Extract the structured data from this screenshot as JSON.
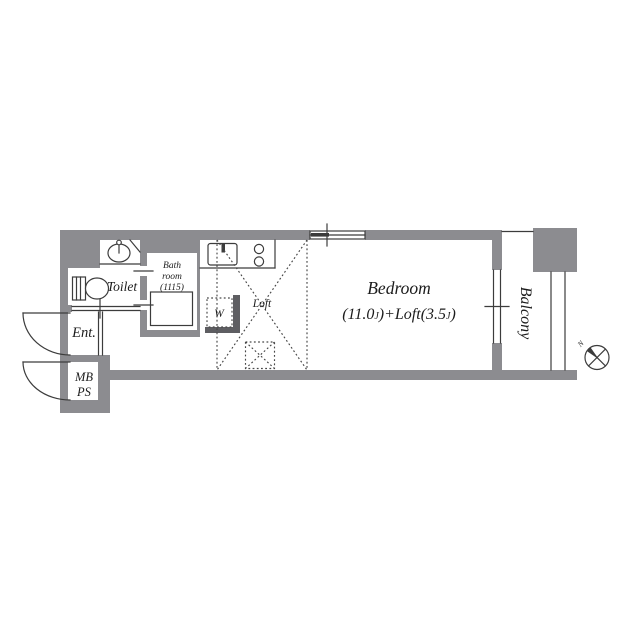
{
  "colors": {
    "wall": "#8c8c90",
    "wall_dark": "#5e5e62",
    "line": "#3c3c3c",
    "text": "#1c1c1c",
    "bg": "#ffffff"
  },
  "rooms": {
    "toilet": {
      "label": "Toilet"
    },
    "bathroom": {
      "label_line1": "Bath",
      "label_line2": "room",
      "label_line3": "(1115)"
    },
    "entrance": {
      "label": "Ent."
    },
    "meter_box": {
      "label_line1": "MB",
      "label_line2": "PS"
    },
    "closet": {
      "label": "W"
    },
    "loft": {
      "label": "Loft"
    },
    "bedroom": {
      "label": "Bedroom",
      "size_open": "(11.0",
      "size_unit1": "J",
      "size_mid": ")+Loft(3.5",
      "size_unit2": "J",
      "size_close": ")"
    },
    "balcony": {
      "label": "Balcony"
    }
  },
  "compass": {
    "north_label": "N"
  }
}
